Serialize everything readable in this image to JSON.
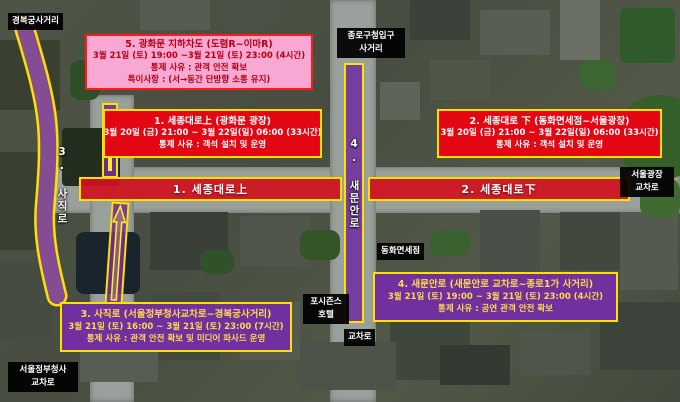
{
  "legend_boxes": {
    "gwanghwamun_underpass": {
      "lines": [
        "5. 광화문 지하차도 (도렴R~이마R)",
        "3월 21일 (토) 19:00 ~3월 21일 (토) 23:00 (4시간)",
        "통제 사유 : 관객 안전 확보",
        "특이사항 : (서→동간 단방향 소통 유지)"
      ]
    },
    "sejongdaero_upper": {
      "lines": [
        "1. 세종대로上 (광화문 광장)",
        "3월 20일 (금) 21:00 ~ 3월 22일(일) 06:00 (33시간)",
        "통제 사유 : 객석 설치 및 운영"
      ]
    },
    "sejongdaero_lower": {
      "lines": [
        "2. 세종대로 下 (동화면세점~서울광장)",
        "3월 20일 (금) 21:00 ~ 3월 22일(일) 06:00 (33시간)",
        "통제 사유 : 객석 설치 및 운영"
      ]
    },
    "sajikro": {
      "lines": [
        "3. 사직로 (서울정부청사교차로~경복궁사거리)",
        "3월 21일 (토) 16:00 ~ 3월 21일 (토) 23:00 (7시간)",
        "통제 사유 : 관객 안전 확보 및 미디어 파사드 운영"
      ]
    },
    "saemunanro": {
      "lines": [
        "4. 새문안로 (새문안로 교차로~종로1가 사거리)",
        "3월 21일 (토) 19:00 ~ 3월 21일 (토) 23:00 (4시간)",
        "통제 사유 : 공연 관객 안전 확보"
      ]
    }
  },
  "road_labels": {
    "sejong_upper_band": "1. 세종대로上",
    "sejong_lower_band": "2. 세종대로下",
    "sajik_band": "3. 사직로",
    "saemunan_band": "4. 새문안로"
  },
  "place_labels": {
    "gyeongbokgung_junction": "경복궁사거리",
    "jongno_office_junction": "종로구청입구\n사거리",
    "seoul_plaza": "서울광장",
    "seoul_plaza_junction": "서울광장\n교차로",
    "donghwa_dutyfree": "동화면세점",
    "four_seasons_hotel": "포시즌스\n호텔",
    "junction": "교차로",
    "gov_complex_junction": "서울정부청사\n교차로"
  },
  "colors": {
    "closure_red": "#e30613",
    "closure_purple": "#7030a0",
    "notice_pink": "#f8a8d2",
    "highlight_yellow": "#ffe100",
    "arrow_yellow": "#ffe92a",
    "label_black": "#000000"
  }
}
